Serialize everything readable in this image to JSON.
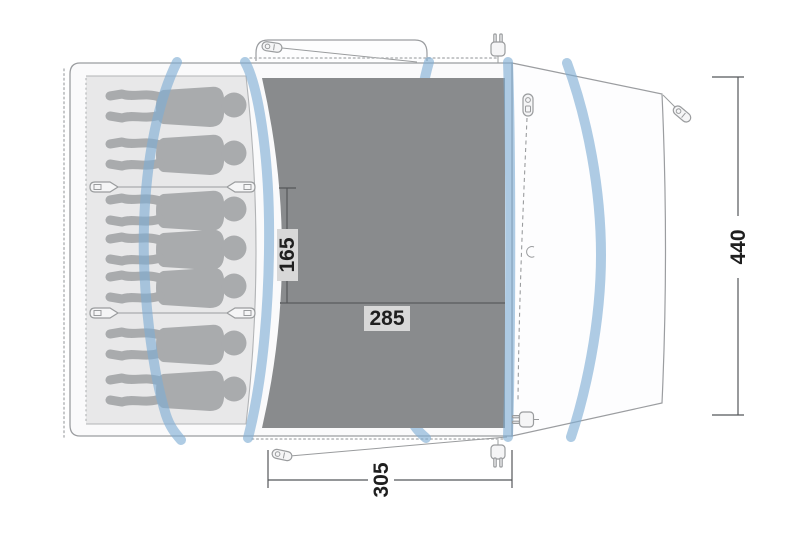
{
  "diagram": {
    "type": "tent-floorplan",
    "sleeping_capacity": 7,
    "labels": {
      "inner_width": "165",
      "living_width": "285",
      "front_width": "305",
      "depth": "440"
    },
    "colors": {
      "body-fill": "#fafafb",
      "porch-fill": "#fdfdfe",
      "cabin-fill": "#e8e8e9",
      "figure-fill": "#a9abad",
      "floor-dark": "#898b8d",
      "floor-divider": "#6b6d6f",
      "pole-blue": "#7eadd4",
      "outline": "#9b9da0",
      "inner-line": "#b2b4b6",
      "dot-line": "#b4b6b8",
      "dim-line": "#55575a",
      "dim-text": "#1f1f1f",
      "label-bg": "#d8d8d8",
      "icon-line": "#9a9c9e",
      "icon-fill": "#f5f5f6"
    }
  }
}
